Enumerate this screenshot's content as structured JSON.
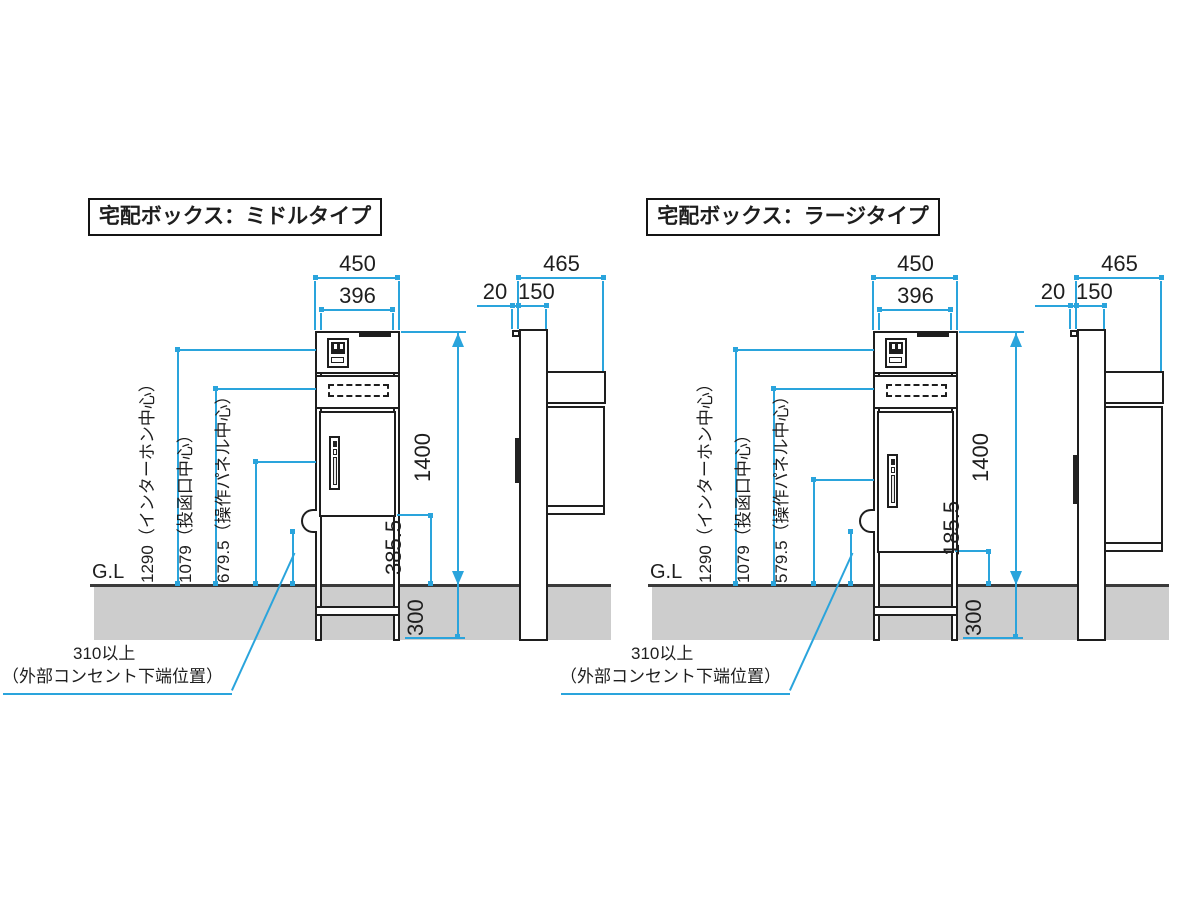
{
  "colors": {
    "dimension_blue": "#2aa4dc",
    "ground_gray": "#cdcdcd",
    "line_black": "#1e1e1e"
  },
  "diagrams": [
    {
      "title": "宅配ボックス：ミドルタイプ",
      "ground_label": "G.L",
      "dims": {
        "overall_width": "450",
        "body_width": "396",
        "overall_depth": "465",
        "front_clearance": "20",
        "post_depth": "150",
        "height_above_ground": "1400",
        "embed_depth": "300",
        "door_bottom_clearance": "385.5",
        "intercom_center": "1290（インターホン中心）",
        "mail_slot_center": "1079（投函口中心）",
        "panel_center": "679.5（操作パネル中心）"
      },
      "outlet_note": {
        "line1": "310以上",
        "line2": "（外部コンセント下端位置）"
      }
    },
    {
      "title": "宅配ボックス：ラージタイプ",
      "ground_label": "G.L",
      "dims": {
        "overall_width": "450",
        "body_width": "396",
        "overall_depth": "465",
        "front_clearance": "20",
        "post_depth": "150",
        "height_above_ground": "1400",
        "embed_depth": "300",
        "door_bottom_clearance": "185.5",
        "intercom_center": "1290（インターホン中心）",
        "mail_slot_center": "1079（投函口中心）",
        "panel_center": "579.5（操作パネル中心）"
      },
      "outlet_note": {
        "line1": "310以上",
        "line2": "（外部コンセント下端位置）"
      }
    }
  ]
}
